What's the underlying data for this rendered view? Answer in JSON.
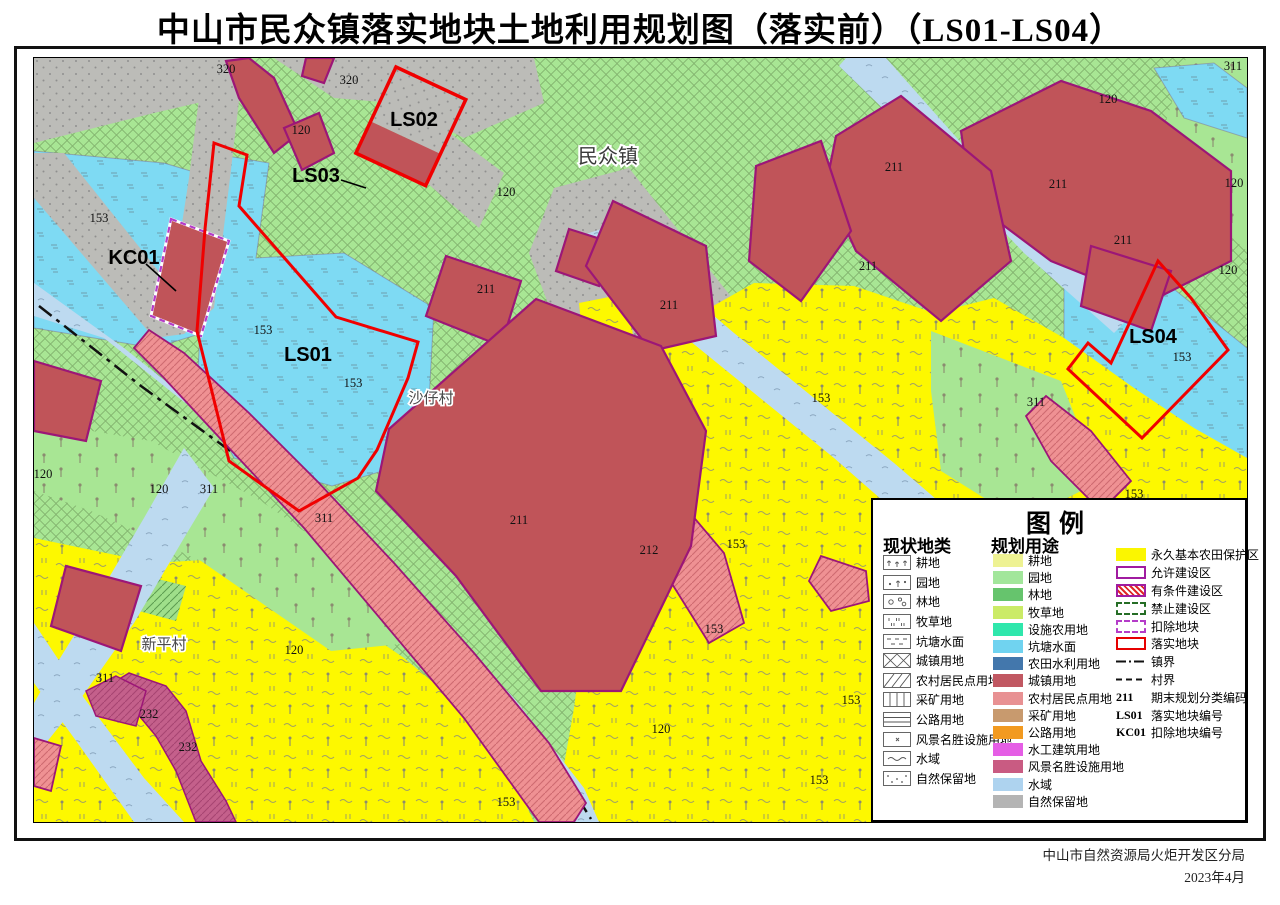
{
  "title": "中山市民众镇落实地块土地利用规划图（落实前）（LS01-LS04）",
  "attribution": {
    "agency": "中山市自然资源局火炬开发区分局",
    "date": "2023年4月"
  },
  "legend": {
    "title": "图例",
    "current_header": "现状地类",
    "planned_header": "规划用途",
    "current": [
      {
        "label": "耕地",
        "pattern": "plant-rows"
      },
      {
        "label": "园地",
        "pattern": "plant-dot"
      },
      {
        "label": "林地",
        "pattern": "circles"
      },
      {
        "label": "牧草地",
        "pattern": "short-vlines"
      },
      {
        "label": "坑塘水面",
        "pattern": "dashes"
      },
      {
        "label": "城镇用地",
        "pattern": "cross-lattice"
      },
      {
        "label": "农村居民点用地",
        "pattern": "diagonal-lines"
      },
      {
        "label": "采矿用地",
        "pattern": "vlines"
      },
      {
        "label": "公路用地",
        "pattern": "hlines"
      },
      {
        "label": "风景名胜设施用地",
        "pattern": "corner-x"
      },
      {
        "label": "水域",
        "pattern": "tilde"
      },
      {
        "label": "自然保留地",
        "pattern": "corner-dots"
      }
    ],
    "planned": [
      {
        "label": "耕地",
        "color": "#eef293"
      },
      {
        "label": "园地",
        "color": "#a2e69b"
      },
      {
        "label": "林地",
        "color": "#66c46d"
      },
      {
        "label": "牧草地",
        "color": "#cbeb67"
      },
      {
        "label": "设施农用地",
        "color": "#2fe7ac"
      },
      {
        "label": "坑塘水面",
        "color": "#70d3f0"
      },
      {
        "label": "农田水利用地",
        "color": "#4377ac"
      },
      {
        "label": "城镇用地",
        "color": "#c15862"
      },
      {
        "label": "农村居民点用地",
        "color": "#e89193"
      },
      {
        "label": "采矿用地",
        "color": "#c89a6e"
      },
      {
        "label": "公路用地",
        "color": "#f29a20"
      },
      {
        "label": "水工建筑用地",
        "color": "#e55ee5"
      },
      {
        "label": "风景名胜设施用地",
        "color": "#c95b82"
      },
      {
        "label": "水域",
        "color": "#aed3ef"
      },
      {
        "label": "自然保留地",
        "color": "#b4b4b4"
      }
    ],
    "zones": [
      {
        "label": "永久基本农田保护区",
        "swatch": "yellow-fill"
      },
      {
        "label": "允许建设区",
        "swatch": "purple-outline"
      },
      {
        "label": "有条件建设区",
        "swatch": "red-hatch"
      },
      {
        "label": "禁止建设区",
        "swatch": "green-dashed"
      },
      {
        "label": "扣除地块",
        "swatch": "purple-dashed"
      },
      {
        "label": "落实地块",
        "swatch": "red-outline"
      },
      {
        "label": "镇界",
        "swatch": "dashdot-line"
      },
      {
        "label": "村界",
        "swatch": "dashed-line"
      },
      {
        "label": "期末规划分类编码",
        "code": "211"
      },
      {
        "label": "落实地块编号",
        "code": "LS01"
      },
      {
        "label": "扣除地块编号",
        "code": "KC01"
      }
    ]
  },
  "map_labels": [
    {
      "text": "320",
      "x": 192,
      "y": 10,
      "k": "code"
    },
    {
      "text": "320",
      "x": 315,
      "y": 21,
      "k": "code"
    },
    {
      "text": "120",
      "x": 267,
      "y": 71,
      "k": "code"
    },
    {
      "text": "120",
      "x": 472,
      "y": 133,
      "k": "code"
    },
    {
      "text": "153",
      "x": 65,
      "y": 159,
      "k": "code"
    },
    {
      "text": "153",
      "x": 229,
      "y": 271,
      "k": "code"
    },
    {
      "text": "153",
      "x": 319,
      "y": 324,
      "k": "code"
    },
    {
      "text": "211",
      "x": 452,
      "y": 230,
      "k": "code"
    },
    {
      "text": "211",
      "x": 635,
      "y": 246,
      "k": "code"
    },
    {
      "text": "211",
      "x": 485,
      "y": 461,
      "k": "code"
    },
    {
      "text": "212",
      "x": 615,
      "y": 491,
      "k": "code"
    },
    {
      "text": "120",
      "x": 9,
      "y": 415,
      "k": "code"
    },
    {
      "text": "120",
      "x": 125,
      "y": 430,
      "k": "code"
    },
    {
      "text": "311",
      "x": 175,
      "y": 430,
      "k": "code"
    },
    {
      "text": "311",
      "x": 290,
      "y": 459,
      "k": "code"
    },
    {
      "text": "153",
      "x": 787,
      "y": 339,
      "k": "code"
    },
    {
      "text": "153",
      "x": 702,
      "y": 485,
      "k": "code"
    },
    {
      "text": "153",
      "x": 680,
      "y": 570,
      "k": "code"
    },
    {
      "text": "120",
      "x": 627,
      "y": 670,
      "k": "code"
    },
    {
      "text": "153",
      "x": 472,
      "y": 743,
      "k": "code"
    },
    {
      "text": "153",
      "x": 817,
      "y": 641,
      "k": "code"
    },
    {
      "text": "153",
      "x": 785,
      "y": 721,
      "k": "code"
    },
    {
      "text": "120",
      "x": 260,
      "y": 591,
      "k": "code"
    },
    {
      "text": "311",
      "x": 71,
      "y": 619,
      "k": "code"
    },
    {
      "text": "232",
      "x": 115,
      "y": 655,
      "k": "code"
    },
    {
      "text": "232",
      "x": 154,
      "y": 688,
      "k": "code"
    },
    {
      "text": "211",
      "x": 860,
      "y": 108,
      "k": "code"
    },
    {
      "text": "120",
      "x": 1074,
      "y": 40,
      "k": "code"
    },
    {
      "text": "211",
      "x": 1024,
      "y": 125,
      "k": "code"
    },
    {
      "text": "211",
      "x": 1089,
      "y": 181,
      "k": "code"
    },
    {
      "text": "211",
      "x": 834,
      "y": 207,
      "k": "code"
    },
    {
      "text": "311",
      "x": 1199,
      "y": 7,
      "k": "code"
    },
    {
      "text": "120",
      "x": 1200,
      "y": 124,
      "k": "code"
    },
    {
      "text": "120",
      "x": 1194,
      "y": 211,
      "k": "code"
    },
    {
      "text": "153",
      "x": 1148,
      "y": 298,
      "k": "code"
    },
    {
      "text": "311",
      "x": 1002,
      "y": 343,
      "k": "code"
    },
    {
      "text": "153",
      "x": 1100,
      "y": 435,
      "k": "code"
    },
    {
      "text": "LS02",
      "x": 380,
      "y": 63,
      "k": "plot"
    },
    {
      "text": "LS03",
      "x": 282,
      "y": 119,
      "k": "plot"
    },
    {
      "text": "KC01",
      "x": 100,
      "y": 201,
      "k": "plot"
    },
    {
      "text": "LS01",
      "x": 274,
      "y": 298,
      "k": "plot"
    },
    {
      "text": "LS04",
      "x": 1119,
      "y": 280,
      "k": "plot"
    },
    {
      "text": "民众镇",
      "x": 574,
      "y": 100,
      "k": "town"
    },
    {
      "text": "沙仔村",
      "x": 397,
      "y": 340,
      "k": "village"
    },
    {
      "text": "新平村",
      "x": 130,
      "y": 586,
      "k": "village"
    }
  ],
  "colors": {
    "orchard_green": "#a8e694",
    "pond_blue": "#7edaf3",
    "river_blue": "#bddaf0",
    "farmland_yellow": "#fdf800",
    "reserve_gray": "#bcbcb8",
    "urban_red": "#c05459",
    "village_salmon": "#ef9193",
    "scenic_pink": "#c4608b",
    "parcel_purple": "#9c1677",
    "plot_red": "#f00000",
    "boundary_black": "#111111"
  }
}
